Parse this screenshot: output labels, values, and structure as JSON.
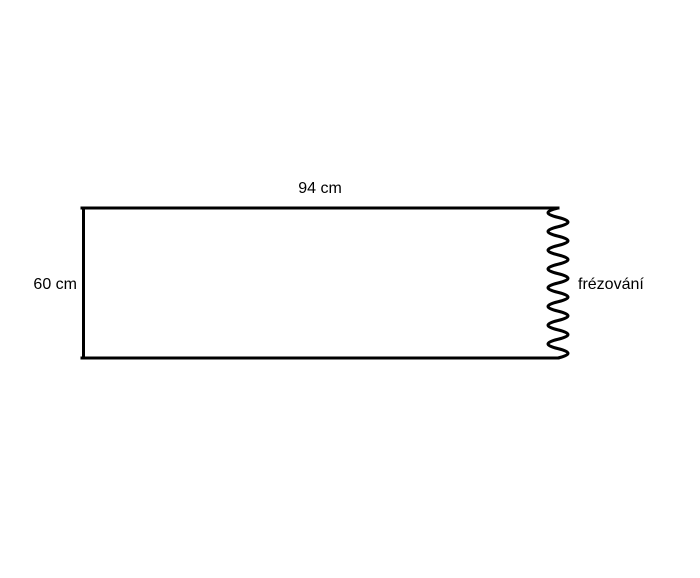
{
  "diagram": {
    "shape": "rectangle-with-milled-right-edge",
    "width_label": "94 cm",
    "height_label": "60 cm",
    "edge_label": "frézování",
    "line_color": "#000000",
    "background_color": "#ffffff"
  }
}
